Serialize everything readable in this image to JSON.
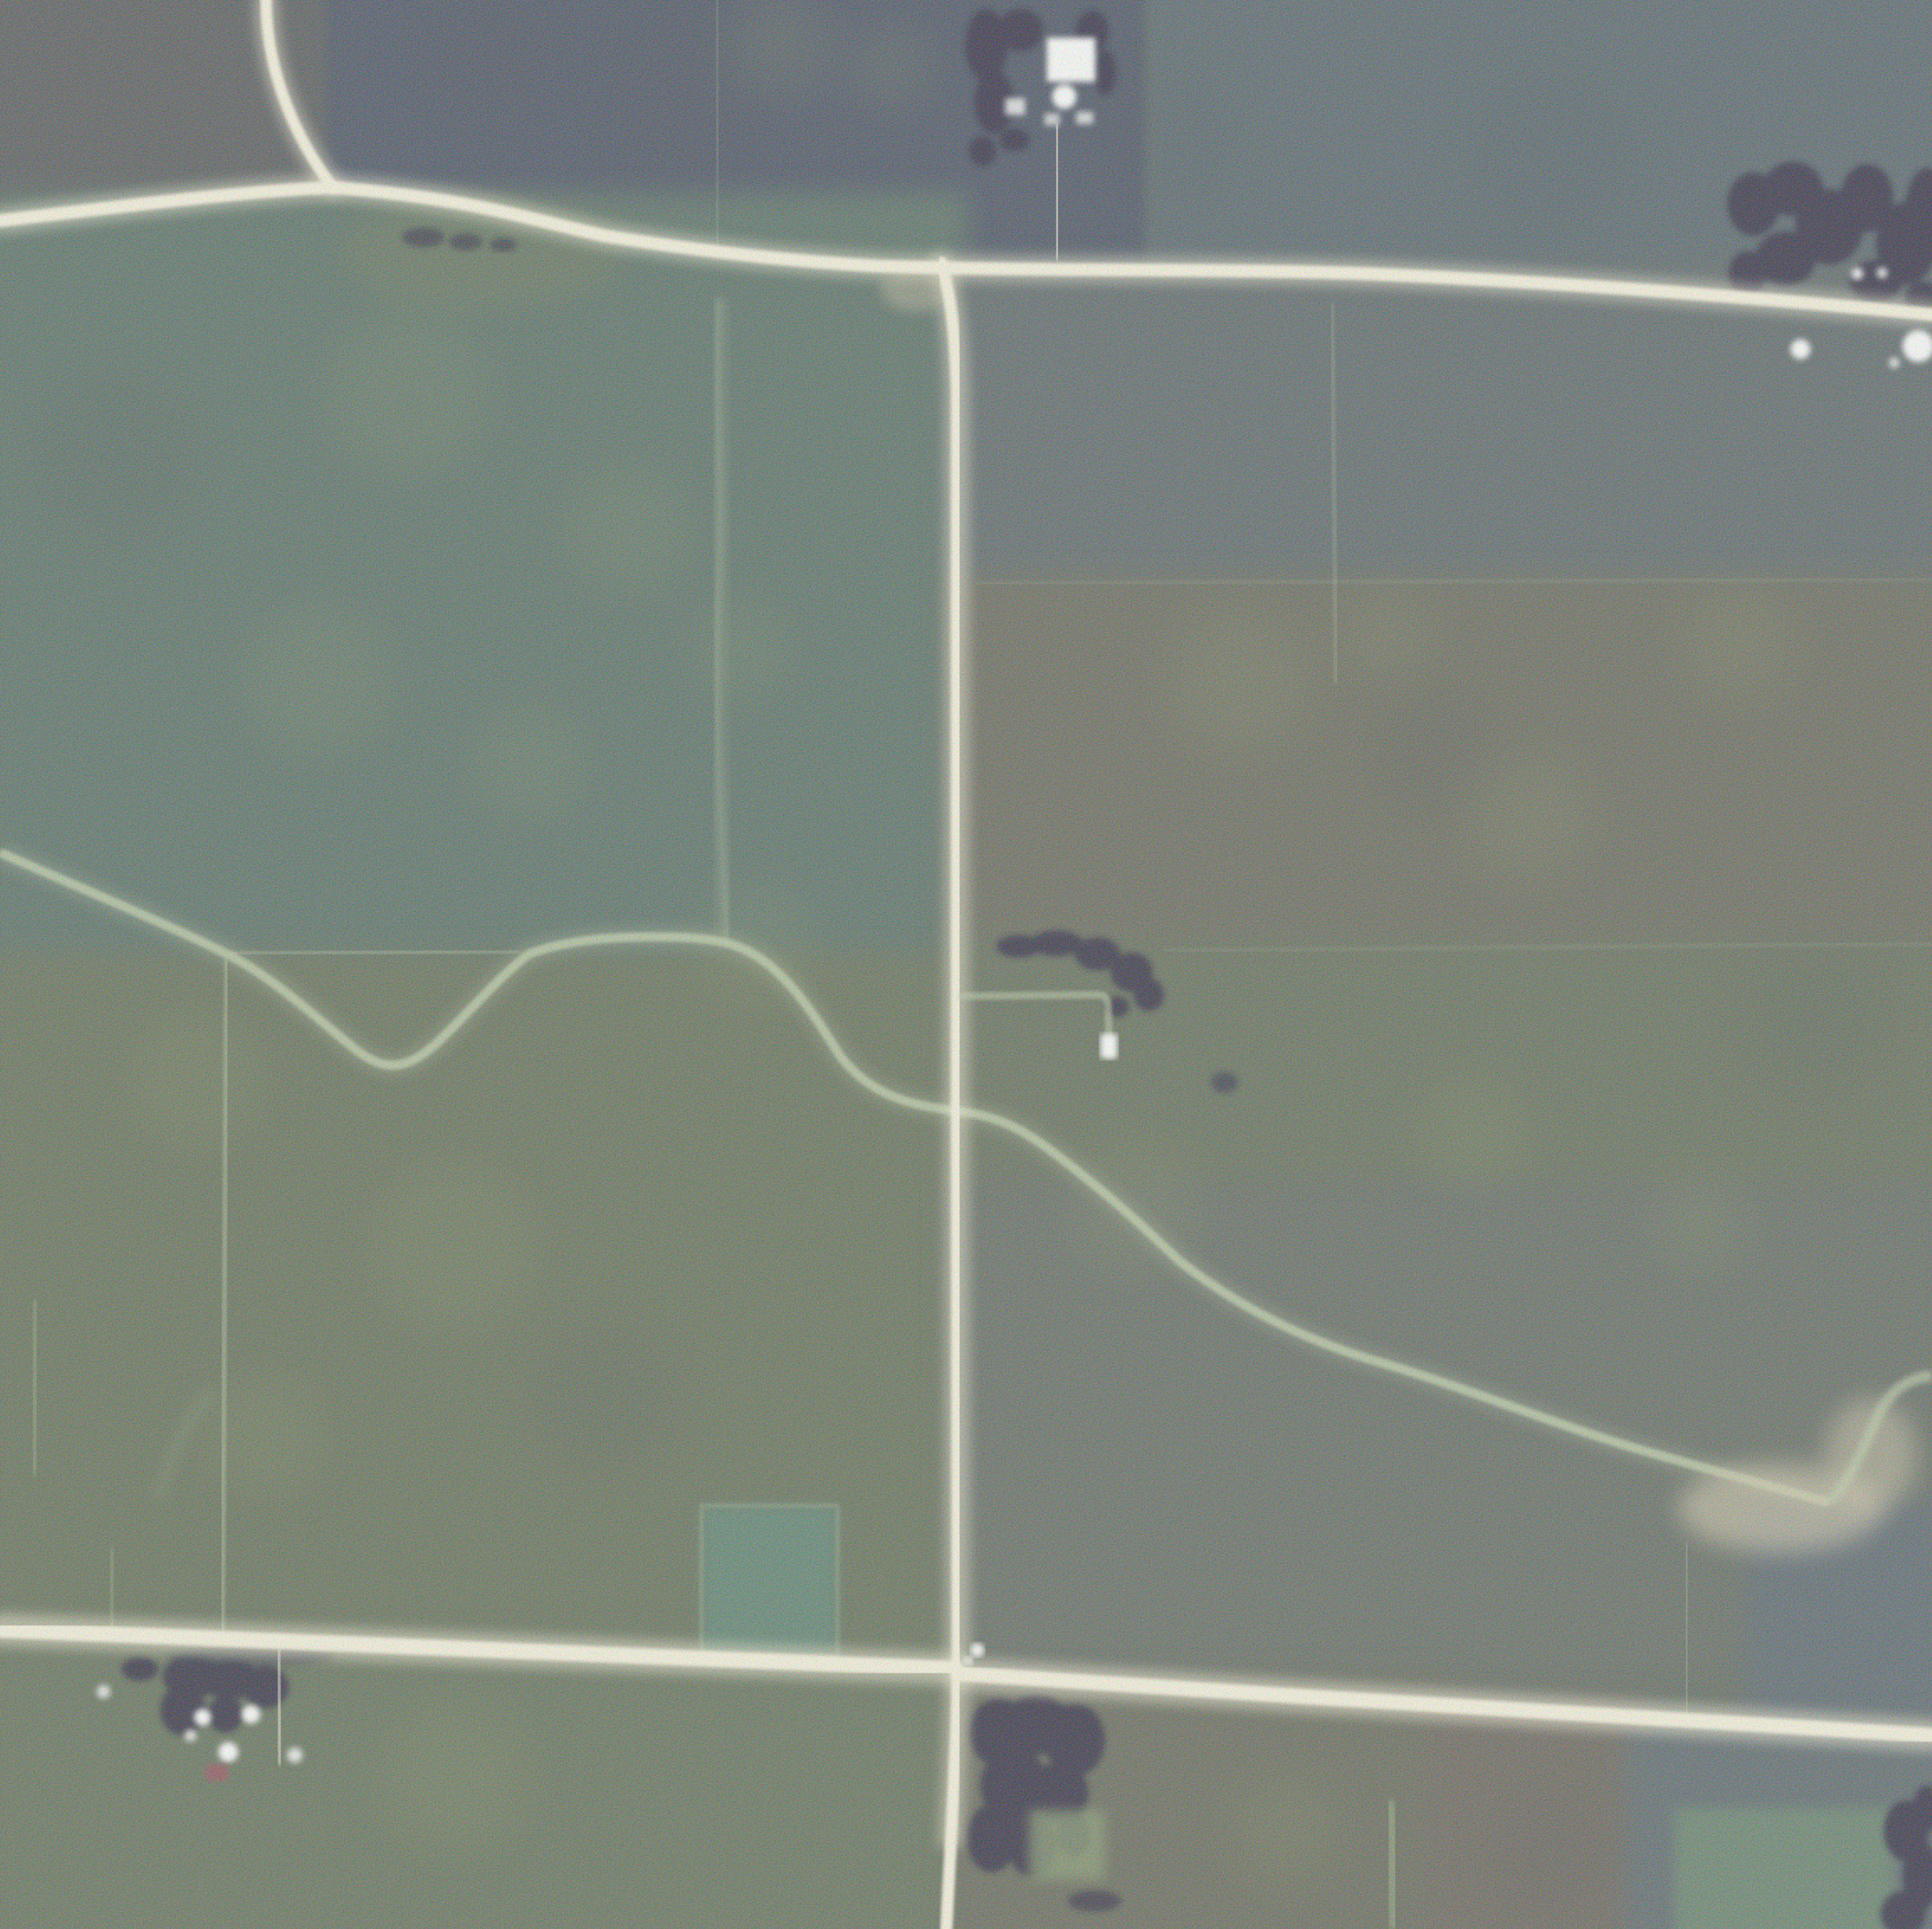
{
  "scene": {
    "type": "aerial-photograph",
    "description": "Grainy color-infrared aerial photograph of rural farmland with gravel roads, crop fields, farmsteads, tree clumps and a meandering creek",
    "features": {
      "top_road": "east-west gravel road across upper image",
      "north_branch_road": "road branch curving to top edge at upper left",
      "vertical_road": "north-south gravel road through center",
      "bottom_road": "east-west gravel road across lower image",
      "creek": "meandering drainage creek crossing image left to lower right",
      "floodplain": "wide tan creek floodplain near right edge",
      "north_farmstead": "farmstead with white buildings and shade trees, top center",
      "northeast_grove": "dark tree grove at upper right with white farm buildings",
      "lane_farm": "short farm lane and white shed east of center road",
      "southwest_farmstead": "farmstead with trees, white buildings and red-roofed shed, lower left",
      "south_woods": "dark rectangular woodlot with clearing, bottom center",
      "southeast_grove": "dark trees along lower right edge",
      "teal_field_patch": "small bright teal-green field patch above bottom road",
      "green_corner_patch": "light green field patch in bottom right corner",
      "grass_waterways": "faint pale-green grassed waterways and field boundary lines"
    }
  },
  "palette": {
    "base": "#515a50",
    "road": "#f7f1dc",
    "road_glow": "#fff8dc",
    "road_apron": "#cdbfa0",
    "creek": "#b7c7a0",
    "creek_halo": "#c8d4ae",
    "creek_tan": "#d3c7a8",
    "waterway": "#9fbc84",
    "trees": "#201a36",
    "clearing": "#7c8f66",
    "building_white": "#ffffff",
    "building_red": "#8a4350",
    "field_nw": "#4a4c50",
    "field_n_navy": "#3a4254",
    "field_ne": "#49565e",
    "field_center_left": "#4c6058",
    "field_sw": "#57614b",
    "field_e_upper": "#50585c",
    "field_e_mid": "#5a5a50",
    "field_e_lower": "#575f4e",
    "field_se": "#545c55",
    "field_se_wedge": "#4d5962",
    "field_bottom_left": "#57624e",
    "field_bottom_mid": "#585a4e",
    "field_bottom_pink": "#5c564f",
    "field_bottom_right": "#4f5a60",
    "patch_teal": "#4f7767",
    "patch_green_br": "#5c7a60",
    "gore_light": "#5e6a50",
    "mottle_light": "#83925e",
    "mottle_dark": "#3a4148"
  }
}
